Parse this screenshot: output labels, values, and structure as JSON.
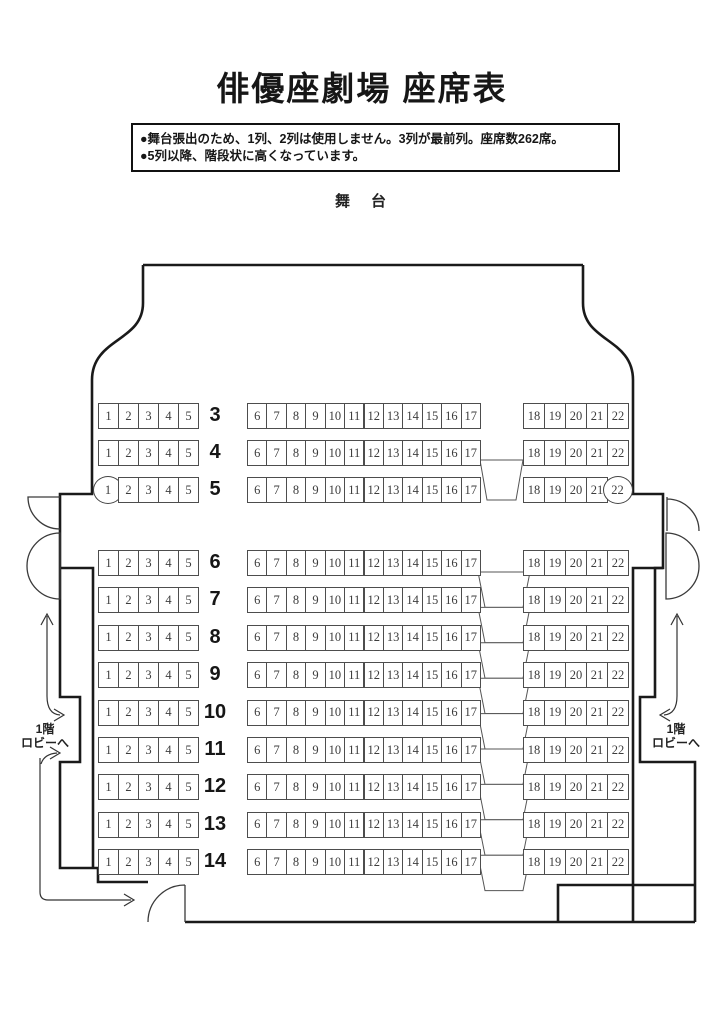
{
  "page": {
    "title": "俳優座劇場 座席表"
  },
  "notes": {
    "line1": "●舞台張出のため、1列、2列は使用しません。3列が最前列。座席数262席。",
    "line2": "●5列以降、階段状に高くなっています。"
  },
  "stage": {
    "label": "舞　台"
  },
  "lobby": {
    "left": {
      "line1": "1階",
      "line2": "ロビーへ"
    },
    "right": {
      "line1": "1階",
      "line2": "ロビーへ"
    }
  },
  "seatmap": {
    "seat_groups": {
      "left": [
        "1",
        "2",
        "3",
        "4",
        "5"
      ],
      "center": [
        "6",
        "7",
        "8",
        "9",
        "10",
        "11",
        "12",
        "13",
        "14",
        "15",
        "16",
        "17"
      ],
      "right": [
        "18",
        "19",
        "20",
        "21",
        "22"
      ]
    },
    "front_rows": [
      "3",
      "4",
      "5"
    ],
    "rear_rows": [
      "6",
      "7",
      "8",
      "9",
      "10",
      "11",
      "12",
      "13",
      "14"
    ],
    "circled_seats": [
      {
        "row": "5",
        "seat": "1"
      },
      {
        "row": "5",
        "seat": "22"
      }
    ]
  }
}
